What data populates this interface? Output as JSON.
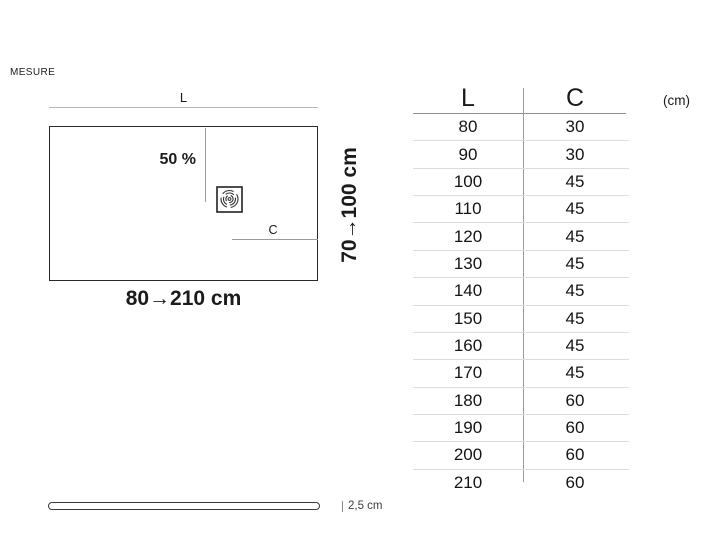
{
  "page": {
    "title_label": "MESURE"
  },
  "diagram": {
    "length_dim_label": "L",
    "slope_label": "50 %",
    "drain_dim_label": "C",
    "length_range_label": "80→210 cm",
    "depth_range_label": "70→100 cm",
    "drain_icon": "drain-icon"
  },
  "profile": {
    "thickness_label": "2,5 cm"
  },
  "table": {
    "headers": [
      "L",
      "C"
    ],
    "unit_label": "(cm)",
    "rows": [
      [
        "80",
        "30"
      ],
      [
        "90",
        "30"
      ],
      [
        "100",
        "45"
      ],
      [
        "110",
        "45"
      ],
      [
        "120",
        "45"
      ],
      [
        "130",
        "45"
      ],
      [
        "140",
        "45"
      ],
      [
        "150",
        "45"
      ],
      [
        "160",
        "45"
      ],
      [
        "170",
        "45"
      ],
      [
        "180",
        "60"
      ],
      [
        "190",
        "60"
      ],
      [
        "200",
        "60"
      ],
      [
        "210",
        "60"
      ]
    ]
  },
  "colors": {
    "ink": "#1b1b1b",
    "outline": "#2b2b2b",
    "dim_line": "#b5b5b5",
    "row_separator": "#dcdcdc"
  }
}
